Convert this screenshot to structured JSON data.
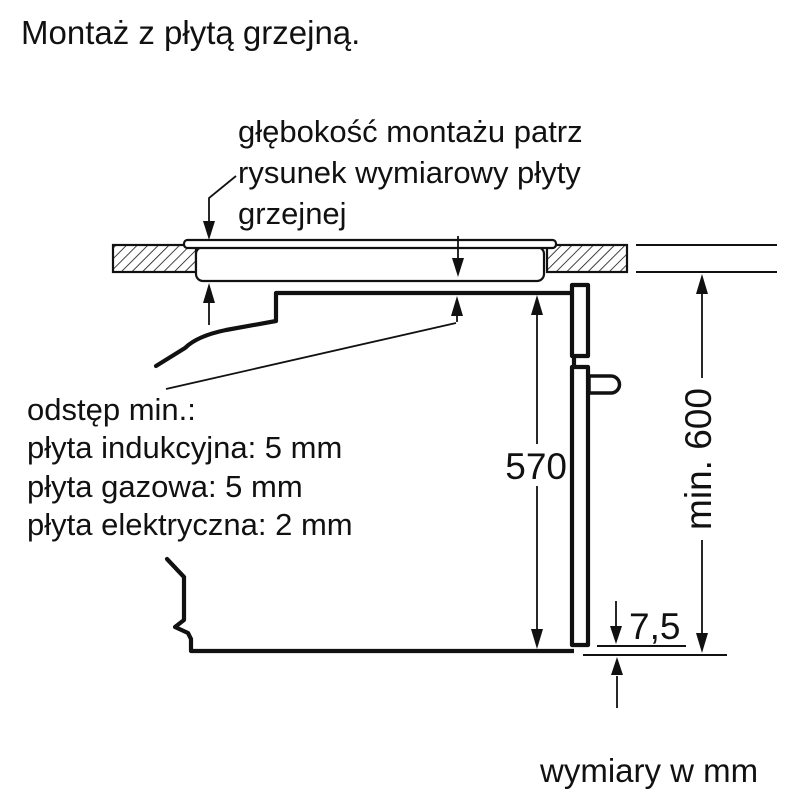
{
  "title": "Montaż z płytą grzejną.",
  "installation_note": {
    "line1": "głębokość montażu patrz",
    "line2": "rysunek wymiarowy płyty",
    "line3": "grzejnej"
  },
  "clearance_note": {
    "heading": "odstęp min.:",
    "induction": "płyta indukcyjna: 5 mm",
    "gas": "płyta gazowa: 5 mm",
    "electric": "płyta elektryczna: 2 mm"
  },
  "dimensions": {
    "oven_height": "570",
    "niche_min_height": "min. 600",
    "bottom_gap": "7,5"
  },
  "footer": {
    "units_note": "wymiary w mm"
  },
  "colors": {
    "ink": "#111111",
    "background": "#ffffff"
  }
}
